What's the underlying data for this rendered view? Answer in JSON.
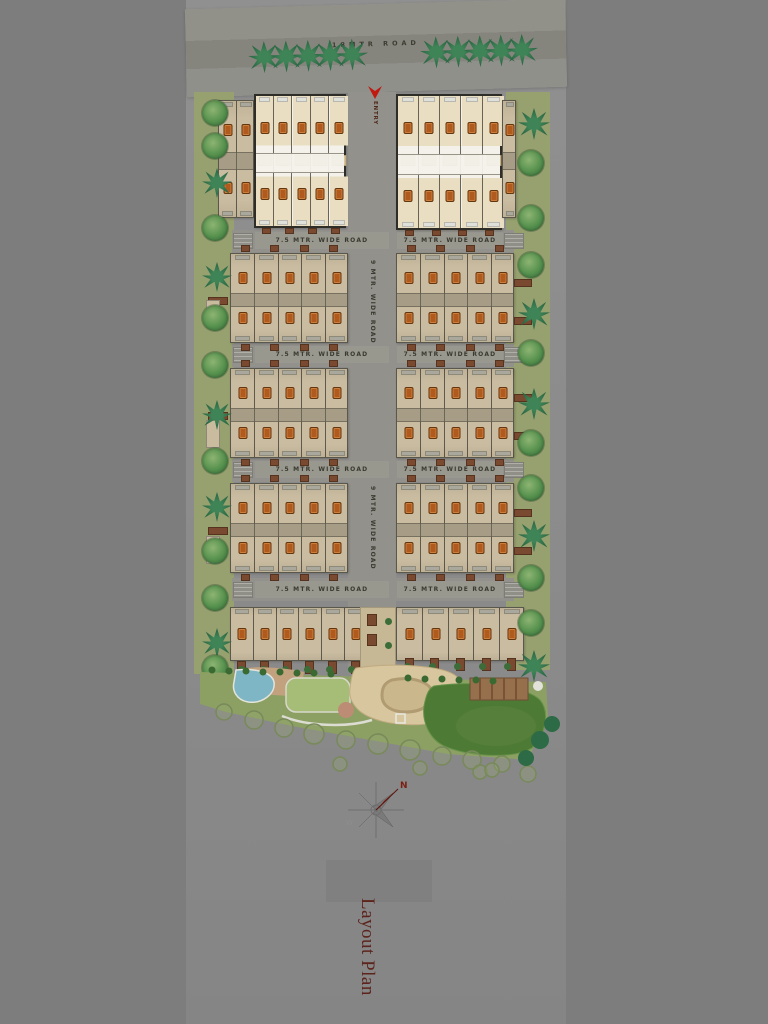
{
  "title": {
    "text": "Layout Plan"
  },
  "roads": {
    "top_label": "18MTR ROAD",
    "entry_label": "ENTRY",
    "cross_labels": [
      "7.5 MTR. WIDE ROAD",
      "7.5 MTR. WIDE ROAD",
      "7.5 MTR. WIDE ROAD",
      "7.5 MTR. WIDE ROAD",
      "7.5 MTR. WIDE ROAD",
      "7.5 MTR. WIDE ROAD",
      "7.5 MTR. WIDE ROAD",
      "7.5 MTR. WIDE ROAD"
    ],
    "center_vertical_labels": [
      "9 MTR. WIDE ROAD",
      "9 MTR. WIDE ROAD"
    ]
  },
  "compass": {
    "north": "N",
    "west": "W"
  },
  "icons": {
    "compass": "compass-rose-icon",
    "entry_arrow": "entry-arrow-icon",
    "round_tree": "round-tree-icon",
    "palm_tree": "palm-tree-icon",
    "unit_marker": "unit-marker-icon"
  },
  "colors": {
    "bg": "#7d7d7d",
    "sheet": "#8b8b8b",
    "tan": "#cabca0",
    "highlight": "#f3f1ea",
    "accent": "#b05a1e",
    "verge": "#97a06f",
    "park": "#8ca064",
    "lawn_dark": "#4d7a35",
    "pool": "#7fb6c6",
    "sand": "#d8c69e",
    "entry": "#c11810",
    "title": "#5c241c"
  }
}
